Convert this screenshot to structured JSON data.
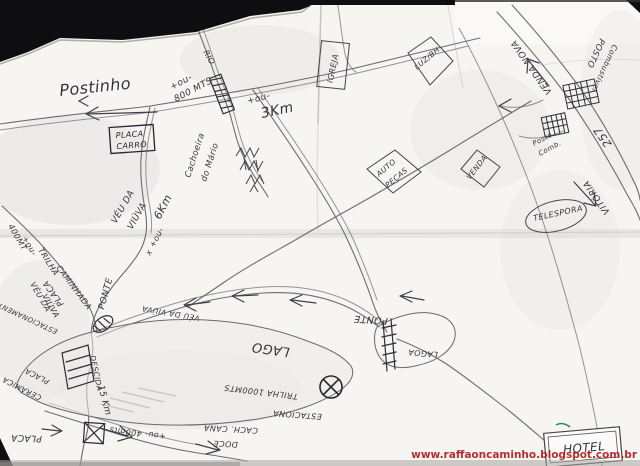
{
  "watermark": "www.raffaoncaminho.blogspot.com.br",
  "labels": {
    "postinho": "Postinho",
    "approx_800m_a": "+ou-",
    "approx_800m_b": "800 MTS",
    "rio": "RIO",
    "approx_3km_a": "+ou-",
    "approx_3km_b": "3Km",
    "placa_sign_a": "PLACA",
    "placa_sign_b": "CARRO",
    "veu_da_viuva_1a": "VÉU DA",
    "veu_da_viuva_1b": "VIÚVA",
    "approx_6km_a": "6Km",
    "approx_6km_b": "+ou-",
    "x_mark": "x",
    "cachoeira_a": "Cachoeira",
    "cachoeira_b": "do Mário",
    "igreja": "IGREJA",
    "luz_bh": "LUZ/BH",
    "venda_nova": "VENDA NOVA",
    "posto_a": "POSTO",
    "posto_b": "Combustível",
    "posto2_a": "Posto",
    "posto2_b": "Comb.",
    "rod_257": "257",
    "vitoria": "VITÓRIA",
    "telespora": "TELESPORA",
    "auto_pecas_a": "AUTO",
    "auto_pecas_b": "PEÇAS",
    "venda": "VENDA",
    "approx_400m_a": "400MT",
    "approx_400m_b": "+ou-",
    "trilha": "TRILHA",
    "caminhada": "CAMINHADA",
    "veu_da_viuva_2a": "VÉU DA",
    "veu_da_viuva_2b": "VIÚVA",
    "ponte_left": "PONTE",
    "placa_mid": "PLACA",
    "estacionamento": "ESTACIONAMENTO",
    "placa_ceramica_a": "PLACA",
    "placa_ceramica_b": "CERÂMICA",
    "placa_bottom": "PLACA",
    "descida": "DESCIDA",
    "dist_15km": "15 Km",
    "approx_400mts": "+ou- 400mts",
    "veu_da_viuva_3": "VÉU DA VIÚVA",
    "lago": "LAGO",
    "lagoa": "LAGOA",
    "ponte_right": "PONTE",
    "trilha_1000": "TRILHA 1000MTS",
    "estaciona": "ESTACIONA",
    "cach_cana_a": "CACH. CANA",
    "cach_cana_b": "DOCE",
    "hotel": "HOTEL"
  }
}
